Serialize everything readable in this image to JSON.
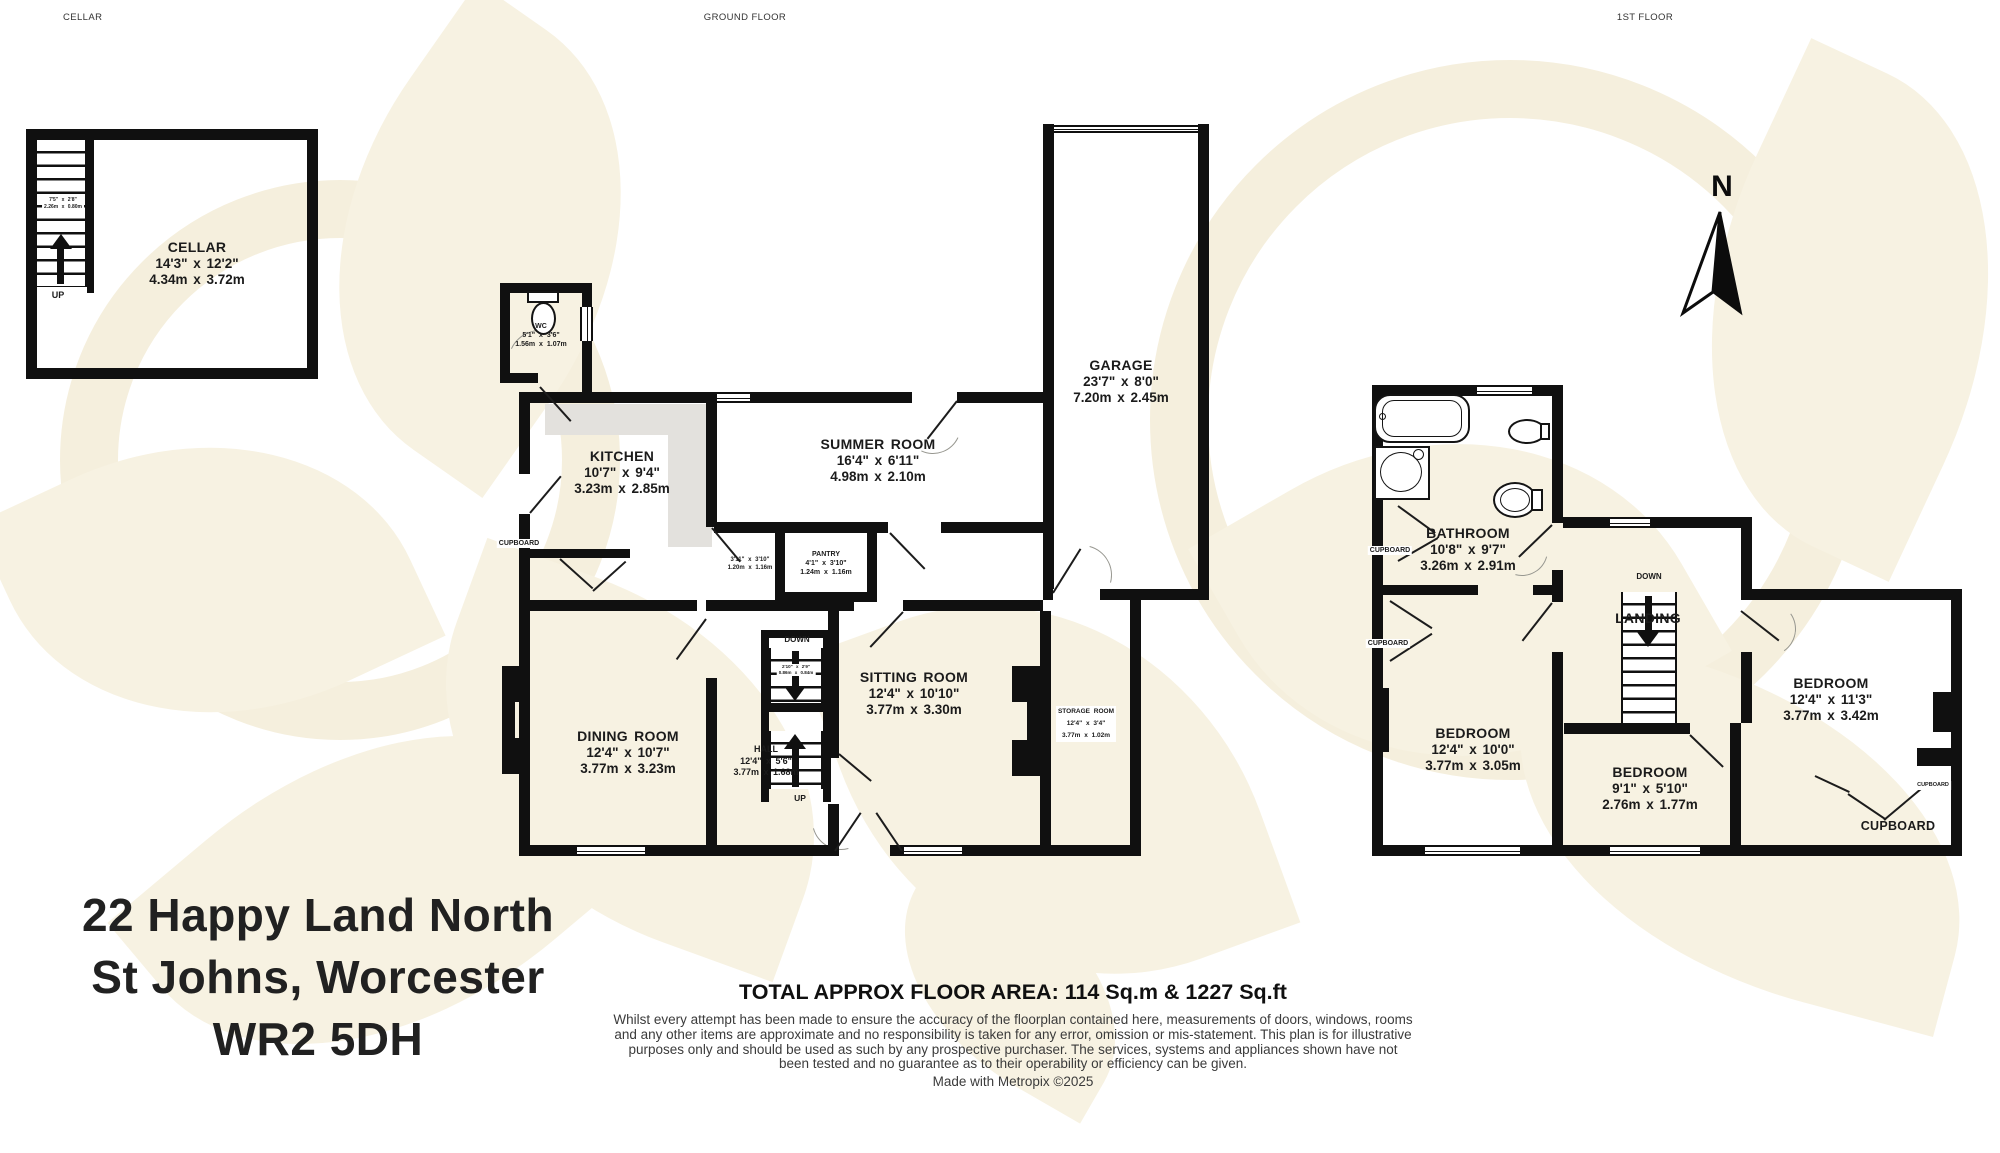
{
  "section_headers": {
    "cellar": "CELLAR",
    "ground_floor": "GROUND FLOOR",
    "first_floor": "1ST FLOOR"
  },
  "compass": {
    "north_label": "N"
  },
  "rooms": {
    "cellar": {
      "name": "CELLAR",
      "imperial": "14'3\" x 12'2\"",
      "metric": "4.34m x 3.72m"
    },
    "wc": {
      "name": "WC",
      "imperial": "5'1\" x 3'6\"",
      "metric": "1.56m x 1.07m"
    },
    "kitchen": {
      "name": "KITCHEN",
      "imperial": "10'7\" x 9'4\"",
      "metric": "3.23m x 2.85m"
    },
    "summer_room": {
      "name": "SUMMER ROOM",
      "imperial": "16'4\" x 6'11\"",
      "metric": "4.98m x 2.10m"
    },
    "pantry": {
      "name": "PANTRY",
      "imperial": "4'1\" x 3'10\"",
      "metric": "1.24m x 1.16m"
    },
    "garage": {
      "name": "GARAGE",
      "imperial": "23'7\" x 8'0\"",
      "metric": "7.20m x 2.45m"
    },
    "sitting_room": {
      "name": "SITTING ROOM",
      "imperial": "12'4\" x 10'10\"",
      "metric": "3.77m x 3.30m"
    },
    "storage_room": {
      "name": "STORAGE ROOM",
      "imperial": "12'4\" x 3'4\"",
      "metric": "3.77m x 1.02m"
    },
    "dining_room": {
      "name": "DINING ROOM",
      "imperial": "12'4\" x 10'7\"",
      "metric": "3.77m x 3.23m"
    },
    "hall": {
      "name": "HALL",
      "imperial": "12'4\" x 5'6\"",
      "metric": "3.77m x 1.68m"
    },
    "bathroom": {
      "name": "BATHROOM",
      "imperial": "10'8\" x 9'7\"",
      "metric": "3.26m x 2.91m"
    },
    "landing": {
      "name": "LANDING"
    },
    "bedroom_left": {
      "name": "BEDROOM",
      "imperial": "12'4\" x 10'0\"",
      "metric": "3.77m x 3.05m"
    },
    "bedroom_middle": {
      "name": "BEDROOM",
      "imperial": "9'1\" x 5'10\"",
      "metric": "2.76m x 1.77m"
    },
    "bedroom_right": {
      "name": "BEDROOM",
      "imperial": "12'4\" x 11'3\"",
      "metric": "3.77m x 3.42m"
    },
    "cupboard_room": {
      "name": "CUPBOARD"
    }
  },
  "small_labels": {
    "up": "UP",
    "down": "DOWN",
    "cupboard": "CUPBOARD",
    "cellar_stairs": {
      "imperial": "7'5\" x 2'8\"",
      "metric": "2.26m x 0.80m"
    },
    "understairs": {
      "imperial": "3'11\" x 3'10\"",
      "metric": "1.20m x 1.16m"
    },
    "ground_stairs": {
      "imperial": "2'10\" x 2'9\"",
      "metric": "0.86m x 0.84m"
    }
  },
  "address": {
    "line1": "22 Happy Land North",
    "line2": "St Johns, Worcester",
    "line3": "WR2 5DH"
  },
  "footer": {
    "total_area": "TOTAL APPROX FLOOR AREA: 114 Sq.m & 1227 Sq.ft",
    "disclaimer": "Whilst every attempt has been made to ensure the accuracy of the floorplan contained here, measurements of doors, windows, rooms and any other items are approximate and no responsibility is taken for any error, omission or mis-statement. This plan is for illustrative purposes only and should be used as such by any prospective purchaser. The services, systems and appliances shown have not been tested and no guarantee as to their operability or efficiency can be given.",
    "credit": "Made with Metropix ©2025"
  },
  "colors": {
    "wall": "#101010",
    "counter": "#e3e1dd",
    "watermark": "#f7f2e2",
    "text": "#1e1e1e"
  }
}
